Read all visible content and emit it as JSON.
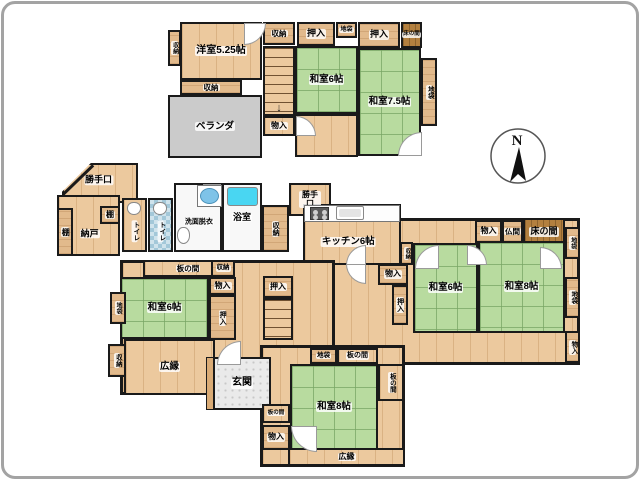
{
  "compass": {
    "label": "N"
  },
  "glyphs": {
    "arrow_down": "↓"
  },
  "palette": {
    "tatami": "#b8db9f",
    "wood": "#ecc99e",
    "closet_wood": "#e2ba8c",
    "dark_wood": "#b3803f",
    "veranda_gray": "#cbcbcb",
    "wall": "#1a1a1a",
    "bathtub": "#49d6f2",
    "tile_blue": "#a3c8d9",
    "genkan_tile": "#eaeaea"
  },
  "areas": [
    {
      "name": "hall-2f",
      "floor": "2F",
      "label": "",
      "x": 295,
      "y": 114,
      "w": 63,
      "h": 43,
      "type": "wood"
    },
    {
      "name": "balcony-veranda",
      "floor": "2F",
      "label": "ベランダ",
      "x": 168,
      "y": 95,
      "w": 94,
      "h": 63,
      "type": "gray",
      "fs": 9.5
    },
    {
      "name": "room-yoshitsu-525",
      "floor": "2F",
      "label": "洋室5.25帖",
      "x": 180,
      "y": 22,
      "w": 82,
      "h": 58,
      "type": "wood",
      "fs": 10
    },
    {
      "name": "closet-shuno-2f-left",
      "floor": "2F",
      "label": "収納",
      "x": 168,
      "y": 30,
      "w": 13,
      "h": 36,
      "type": "woodplain",
      "fs": 6,
      "vert": true
    },
    {
      "name": "closet-shuno-2f-top",
      "floor": "2F",
      "label": "収納",
      "x": 263,
      "y": 22,
      "w": 32,
      "h": 23,
      "type": "woodplain",
      "fs": 7.5
    },
    {
      "name": "closet-oshiire-2f-1",
      "floor": "2F",
      "label": "押入",
      "x": 297,
      "y": 22,
      "w": 38,
      "h": 24,
      "type": "woodplain",
      "fs": 9
    },
    {
      "name": "closet-jibukuro-2f-top",
      "floor": "2F",
      "label": "地袋",
      "x": 336,
      "y": 22,
      "w": 21,
      "h": 16,
      "type": "woodplain",
      "fs": 6
    },
    {
      "name": "closet-oshiire-2f-2",
      "floor": "2F",
      "label": "押入",
      "x": 358,
      "y": 22,
      "w": 42,
      "h": 26,
      "type": "woodplain",
      "fs": 9
    },
    {
      "name": "alcove-tokonoma-2f",
      "floor": "2F",
      "label": "床の間",
      "x": 401,
      "y": 22,
      "w": 21,
      "h": 26,
      "type": "darkwood",
      "fs": 5.5
    },
    {
      "name": "room-washitsu-6-2f",
      "floor": "2F",
      "label": "和室6帖",
      "x": 295,
      "y": 46,
      "w": 63,
      "h": 68,
      "type": "tatami",
      "fs": 9.5
    },
    {
      "name": "room-washitsu-75-2f",
      "floor": "2F",
      "label": "和室7.5帖",
      "x": 358,
      "y": 48,
      "w": 63,
      "h": 108,
      "type": "tatami",
      "fs": 9.5
    },
    {
      "name": "closet-jibukuro-2f-right",
      "floor": "2F",
      "label": "地袋",
      "x": 421,
      "y": 58,
      "w": 16,
      "h": 68,
      "type": "woodplain",
      "fs": 6.5,
      "vert": true
    },
    {
      "name": "stairs-2f",
      "floor": "2F",
      "label": "",
      "x": 263,
      "y": 46,
      "w": 32,
      "h": 70,
      "type": "stairs",
      "arrow": true
    },
    {
      "name": "closet-monoire-2f",
      "floor": "2F",
      "label": "物入",
      "x": 263,
      "y": 116,
      "w": 32,
      "h": 20,
      "type": "wood",
      "fs": 8
    },
    {
      "name": "closet-shuno-2f-below",
      "floor": "2F",
      "label": "収納",
      "x": 180,
      "y": 80,
      "w": 62,
      "h": 15,
      "type": "woodplain",
      "fs": 7.5
    },
    {
      "name": "entry-katteguchi-1",
      "floor": "1F",
      "label": "勝手口",
      "x": 62,
      "y": 163,
      "w": 76,
      "h": 40,
      "type": "wood",
      "fs": 9,
      "lx": 0.48,
      "ly": 0.42,
      "clip": "polygon(38% 0, 100% 0, 100% 100%, 0 100%, 0 72%)",
      "diag": true
    },
    {
      "name": "storage-nando",
      "floor": "1F",
      "label": "納戸",
      "x": 57,
      "y": 195,
      "w": 63,
      "h": 61,
      "type": "wood",
      "fs": 9,
      "lx": 0.52,
      "ly": 0.65
    },
    {
      "name": "shelf-tana-left",
      "floor": "1F",
      "label": "棚",
      "x": 57,
      "y": 208,
      "w": 16,
      "h": 48,
      "type": "woodplain",
      "fs": 8,
      "vert": true
    },
    {
      "name": "shelf-tana-top",
      "floor": "1F",
      "label": "棚",
      "x": 100,
      "y": 206,
      "w": 20,
      "h": 18,
      "type": "woodplain",
      "fs": 8
    },
    {
      "name": "room-toilet-1",
      "floor": "1F",
      "label": "トイレ",
      "x": 122,
      "y": 198,
      "w": 25,
      "h": 54,
      "type": "wood",
      "fs": 6.5,
      "vert": true,
      "lx": 0.5,
      "ly": 0.62
    },
    {
      "name": "room-toilet-2",
      "floor": "1F",
      "label": "トイレ",
      "x": 148,
      "y": 198,
      "w": 25,
      "h": 54,
      "type": "bluetile",
      "fs": 6.5,
      "vert": true,
      "lx": 0.5,
      "ly": 0.62
    },
    {
      "name": "room-senmen-datsui",
      "floor": "1F",
      "label": "洗面脱衣",
      "x": 174,
      "y": 183,
      "w": 48,
      "h": 69,
      "type": "white",
      "fs": 7,
      "lx": 0.52,
      "ly": 0.57
    },
    {
      "name": "room-yokushitsu",
      "floor": "1F",
      "label": "浴室",
      "x": 222,
      "y": 183,
      "w": 40,
      "h": 69,
      "type": "white",
      "fs": 9
    },
    {
      "name": "closet-shuno-bath",
      "floor": "1F",
      "label": "収納",
      "x": 262,
      "y": 205,
      "w": 27,
      "h": 47,
      "type": "woodplain",
      "fs": 7,
      "vert": true
    },
    {
      "name": "entry-katteguchi-2",
      "floor": "1F",
      "label": "勝手口",
      "x": 289,
      "y": 183,
      "w": 42,
      "h": 33,
      "type": "wood",
      "fs": 8,
      "wrap": true
    },
    {
      "name": "hall-east",
      "floor": "1F",
      "label": "",
      "x": 331,
      "y": 218,
      "w": 249,
      "h": 147,
      "type": "wood",
      "base": true
    },
    {
      "name": "room-kitchen",
      "floor": "1F",
      "label": "キッチン6帖",
      "x": 303,
      "y": 204,
      "w": 98,
      "h": 61,
      "type": "wood",
      "fs": 9.5,
      "lx": 0.46,
      "ly": 0.63
    },
    {
      "name": "closet-monoire-east-top",
      "floor": "1F",
      "label": "物入",
      "x": 475,
      "y": 220,
      "w": 27,
      "h": 23,
      "type": "woodplain",
      "fs": 8
    },
    {
      "name": "room-butsuma",
      "floor": "1F",
      "label": "仏間",
      "x": 502,
      "y": 220,
      "w": 21,
      "h": 23,
      "type": "woodplain",
      "fs": 7.5
    },
    {
      "name": "alcove-tokonoma-1f",
      "floor": "1F",
      "label": "床の間",
      "x": 523,
      "y": 218,
      "w": 42,
      "h": 28,
      "type": "darkwood",
      "fs": 9
    },
    {
      "name": "closet-jibukuro-east-top",
      "floor": "1F",
      "label": "地袋",
      "x": 565,
      "y": 227,
      "w": 15,
      "h": 32,
      "type": "woodplain",
      "fs": 6,
      "vert": true
    },
    {
      "name": "room-washitsu-6-east",
      "floor": "1F",
      "label": "和室6帖",
      "x": 413,
      "y": 243,
      "w": 65,
      "h": 90,
      "type": "tatami",
      "fs": 9.5
    },
    {
      "name": "room-washitsu-8-east",
      "floor": "1F",
      "label": "和室8帖",
      "x": 478,
      "y": 241,
      "w": 87,
      "h": 92,
      "type": "tatami",
      "fs": 9.5
    },
    {
      "name": "closet-jibukuro-east-mid",
      "floor": "1F",
      "label": "地袋",
      "x": 565,
      "y": 277,
      "w": 15,
      "h": 41,
      "type": "woodplain",
      "fs": 6.5,
      "vert": true
    },
    {
      "name": "closet-monoire-east-bottom",
      "floor": "1F",
      "label": "物入",
      "x": 565,
      "y": 331,
      "w": 15,
      "h": 32,
      "type": "woodplain",
      "fs": 6.5,
      "vert": true
    },
    {
      "name": "closet-shuno-kitchen",
      "floor": "1F",
      "label": "収納",
      "x": 400,
      "y": 242,
      "w": 13,
      "h": 23,
      "type": "woodplain",
      "fs": 5.5,
      "vert": true
    },
    {
      "name": "closet-monoire-center",
      "floor": "1F",
      "label": "物入",
      "x": 378,
      "y": 264,
      "w": 30,
      "h": 21,
      "type": "woodplain",
      "fs": 8
    },
    {
      "name": "closet-oshiire-center",
      "floor": "1F",
      "label": "押入",
      "x": 392,
      "y": 285,
      "w": 16,
      "h": 40,
      "type": "woodplain",
      "fs": 7,
      "vert": true
    },
    {
      "name": "hall-center",
      "floor": "1F",
      "label": "",
      "x": 120,
      "y": 260,
      "w": 215,
      "h": 135,
      "type": "wood",
      "base": true
    },
    {
      "name": "floor-itanoma-west",
      "floor": "1F",
      "label": "板の間",
      "x": 143,
      "y": 260,
      "w": 90,
      "h": 17,
      "type": "wood",
      "fs": 7.5
    },
    {
      "name": "closet-shuno-itanoma",
      "floor": "1F",
      "label": "収納",
      "x": 211,
      "y": 260,
      "w": 24,
      "h": 17,
      "type": "woodplain",
      "fs": 6.5
    },
    {
      "name": "closet-monoire-west",
      "floor": "1F",
      "label": "物入",
      "x": 209,
      "y": 277,
      "w": 27,
      "h": 18,
      "type": "woodplain",
      "fs": 8
    },
    {
      "name": "room-washitsu-6-west",
      "floor": "1F",
      "label": "和室6帖",
      "x": 120,
      "y": 277,
      "w": 89,
      "h": 62,
      "type": "tatami",
      "fs": 9.5
    },
    {
      "name": "closet-oshiire-west",
      "floor": "1F",
      "label": "押入",
      "x": 209,
      "y": 295,
      "w": 27,
      "h": 45,
      "type": "woodplain",
      "fs": 7,
      "vert": true
    },
    {
      "name": "closet-jibukuro-west",
      "floor": "1F",
      "label": "地袋",
      "x": 110,
      "y": 292,
      "w": 16,
      "h": 32,
      "type": "woodplain",
      "fs": 6,
      "vert": true
    },
    {
      "name": "closet-shuno-west",
      "floor": "1F",
      "label": "収納",
      "x": 108,
      "y": 344,
      "w": 18,
      "h": 33,
      "type": "woodplain",
      "fs": 6.5,
      "vert": true
    },
    {
      "name": "room-hiroen-west",
      "floor": "1F",
      "label": "広縁",
      "x": 124,
      "y": 339,
      "w": 91,
      "h": 56,
      "type": "wood",
      "fs": 9.5
    },
    {
      "name": "closet-oshiire-stairs",
      "floor": "1F",
      "label": "押入",
      "x": 263,
      "y": 276,
      "w": 30,
      "h": 22,
      "type": "woodplain",
      "fs": 8
    },
    {
      "name": "stairs-1f",
      "floor": "1F",
      "label": "",
      "x": 263,
      "y": 298,
      "w": 30,
      "h": 42,
      "type": "stairs"
    },
    {
      "name": "hall-south",
      "floor": "1F",
      "label": "",
      "x": 260,
      "y": 345,
      "w": 145,
      "h": 122,
      "type": "wood",
      "base": true
    },
    {
      "name": "entry-genkan",
      "floor": "1F",
      "label": "玄関",
      "x": 213,
      "y": 357,
      "w": 58,
      "h": 53,
      "type": "tile",
      "fs": 10
    },
    {
      "name": "closet-jibukuro-south",
      "floor": "1F",
      "label": "地袋",
      "x": 310,
      "y": 348,
      "w": 27,
      "h": 16,
      "type": "woodplain",
      "fs": 6.5
    },
    {
      "name": "floor-itanoma-south-top",
      "floor": "1F",
      "label": "板の間",
      "x": 337,
      "y": 348,
      "w": 41,
      "h": 16,
      "type": "wood",
      "fs": 7
    },
    {
      "name": "floor-itanoma-south-right",
      "floor": "1F",
      "label": "板の間",
      "x": 378,
      "y": 364,
      "w": 26,
      "h": 37,
      "type": "wood",
      "fs": 6.5,
      "vert": true
    },
    {
      "name": "room-washitsu-8-south",
      "floor": "1F",
      "label": "和室8帖",
      "x": 290,
      "y": 364,
      "w": 88,
      "h": 86,
      "type": "tatami",
      "fs": 9.5
    },
    {
      "name": "floor-itanoma-south-left",
      "floor": "1F",
      "label": "板の間",
      "x": 262,
      "y": 404,
      "w": 28,
      "h": 19,
      "type": "wood",
      "fs": 5.5
    },
    {
      "name": "closet-monoire-south",
      "floor": "1F",
      "label": "物入",
      "x": 262,
      "y": 425,
      "w": 28,
      "h": 25,
      "type": "woodplain",
      "fs": 8
    },
    {
      "name": "room-hiroen-south",
      "floor": "1F",
      "label": "広縁",
      "x": 288,
      "y": 448,
      "w": 117,
      "h": 18,
      "type": "wood",
      "fs": 8
    }
  ],
  "doors": [
    {
      "x": 244,
      "y": 23,
      "s": 20,
      "c": "br"
    },
    {
      "x": 296,
      "y": 116,
      "s": 18,
      "c": "tr"
    },
    {
      "x": 398,
      "y": 132,
      "s": 22,
      "c": "tl"
    },
    {
      "x": 415,
      "y": 245,
      "s": 22,
      "c": "tl"
    },
    {
      "x": 540,
      "y": 247,
      "s": 20,
      "c": "tr"
    },
    {
      "x": 467,
      "y": 245,
      "s": 18,
      "c": "tr"
    },
    {
      "x": 346,
      "y": 245,
      "s": 18,
      "c": "tl"
    },
    {
      "x": 346,
      "y": 264,
      "s": 18,
      "c": "bl"
    },
    {
      "x": 217,
      "y": 341,
      "s": 22,
      "c": "tl"
    },
    {
      "x": 291,
      "y": 426,
      "s": 24,
      "c": "bl"
    },
    {
      "x": 203,
      "y": 184,
      "s": 16,
      "c": "bl"
    }
  ],
  "fixtures": [
    {
      "name": "washing-machine",
      "kind": "washer",
      "x": 197,
      "y": 185,
      "w": 25,
      "h": 22
    },
    {
      "name": "bathtub",
      "kind": "tub",
      "x": 227,
      "y": 187,
      "w": 31,
      "h": 19
    },
    {
      "name": "kitchen-counter",
      "kind": "counter",
      "x": 304,
      "y": 205,
      "w": 96,
      "h": 17
    },
    {
      "name": "stove",
      "kind": "stove",
      "x": 310,
      "y": 207,
      "w": 19,
      "h": 13
    },
    {
      "name": "kitchen-sink",
      "kind": "sink",
      "x": 336,
      "y": 206,
      "w": 28,
      "h": 14
    },
    {
      "name": "wash-basin",
      "kind": "basin",
      "x": 177,
      "y": 227,
      "w": 13,
      "h": 17
    },
    {
      "name": "toilet-bowl-1",
      "kind": "toilet",
      "x": 127,
      "y": 202,
      "w": 14,
      "h": 13
    },
    {
      "name": "toilet-bowl-2",
      "kind": "toilet",
      "x": 153,
      "y": 202,
      "w": 14,
      "h": 13
    },
    {
      "name": "genkan-step",
      "kind": "step",
      "x": 206,
      "y": 357,
      "w": 8,
      "h": 53
    }
  ]
}
